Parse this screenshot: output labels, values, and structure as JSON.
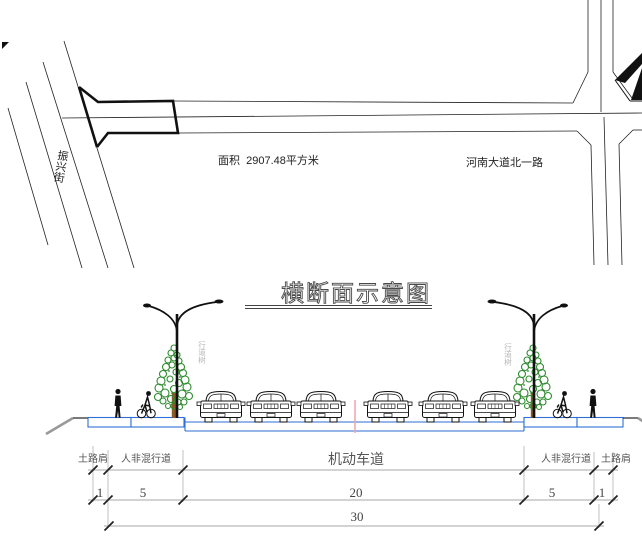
{
  "plan": {
    "street_label": "振兴街",
    "area_label": "面积  2907.48平方米",
    "road_name_label": "河南大道北一路"
  },
  "section": {
    "title": "横断面示意图",
    "tree_label": "行道树",
    "labels": [
      "土路肩",
      "人非混行道",
      "机动车道",
      "人非混行道",
      "土路肩"
    ],
    "dims": [
      "1",
      "5",
      "20",
      "5",
      "1"
    ],
    "total_dim": "30"
  },
  "colors": {
    "road_blue": "#2e6ed6",
    "centerline_pink": "#f0a8b0",
    "foliage_green": "#2e8b2e",
    "trunk_brown": "#8a5a2b",
    "dim_line_gray": "#8a8a8a",
    "slope_gray": "#999999"
  }
}
